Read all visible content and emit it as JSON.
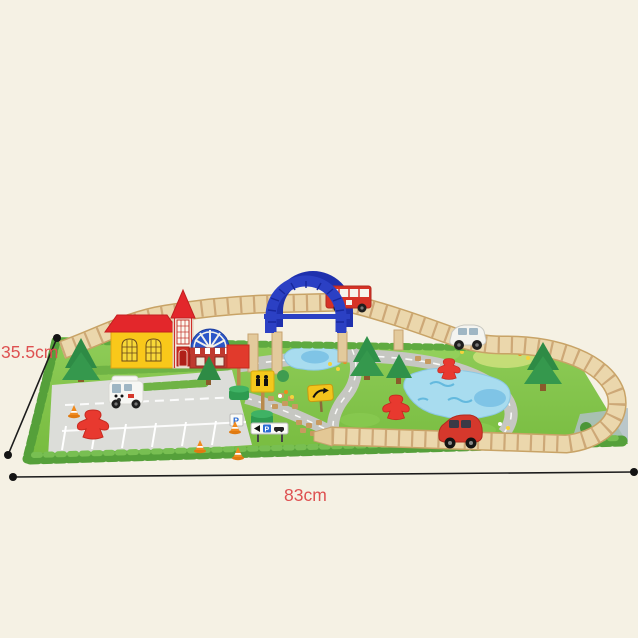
{
  "annotations": {
    "depth": {
      "label": "35.5cm"
    },
    "width": {
      "label": "83cm"
    }
  },
  "signs": {
    "parking_board_letter": "P",
    "direction_board_letter": "P"
  },
  "colors": {
    "background": "#F5F1E4",
    "annotation_text": "#DE5151",
    "dimension_line": "#1C1C1C",
    "mat_green": "#82C34A",
    "track_wood": "#EAD6AC",
    "bridge_blue": "#2B40C4",
    "bus_red": "#D63226",
    "roof_red": "#E3272B",
    "house_yellow": "#F9C81A",
    "station_blue": "#2B57C8",
    "pond_blue": "#A8DCEF",
    "road_gray": "#C6C7C2",
    "tree_green": "#2E8B45",
    "figure_red": "#E8392F",
    "cone_orange": "#F08A1E",
    "sign_yellow": "#F4C81C",
    "sign_base_green": "#2E9B50"
  },
  "objects": [
    "playmat",
    "wooden-track",
    "arch-bridge",
    "double-decker-bus",
    "yellow-house",
    "church-tower",
    "station-building",
    "pine-trees",
    "white-van",
    "white-car",
    "red-car",
    "red-figures",
    "traffic-signs",
    "traffic-cones",
    "ponds",
    "parking-lot"
  ]
}
